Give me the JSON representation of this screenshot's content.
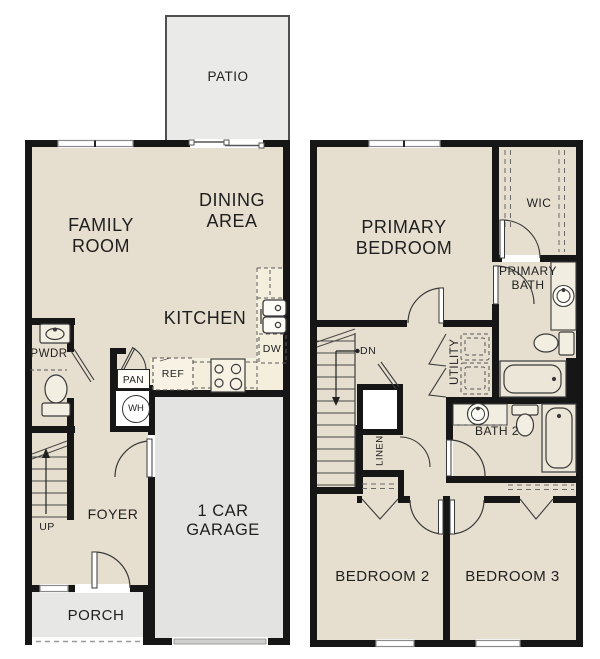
{
  "first_floor": {
    "patio": "PATIO",
    "family_room": "FAMILY ROOM",
    "dining_area": "DINING AREA",
    "kitchen": "KITCHEN",
    "powder_room": "PWDR",
    "pantry": "PAN",
    "refrigerator": "REF",
    "dishwasher": "DW",
    "water_heater": "WH",
    "stairs_direction": "UP",
    "foyer": "FOYER",
    "garage": "1 CAR GARAGE",
    "porch": "PORCH"
  },
  "second_floor": {
    "primary_bedroom": "PRIMARY BEDROOM",
    "walk_in_closet": "WIC",
    "primary_bath": "PRIMARY BATH",
    "stairs_direction": "DN",
    "utility": "UTILITY",
    "linen": "LINEN",
    "bath_2": "BATH 2",
    "bedroom_2": "BEDROOM 2",
    "bedroom_3": "BEDROOM 3"
  },
  "palette": {
    "floor": "#e6dfcf",
    "wall": "#161616",
    "garage_floor": "#e3e3e1",
    "patio_floor": "#eaeae8",
    "counter": "#f4eedd",
    "fixture_line": "#3a3a3a",
    "text": "#1f1f1f"
  }
}
